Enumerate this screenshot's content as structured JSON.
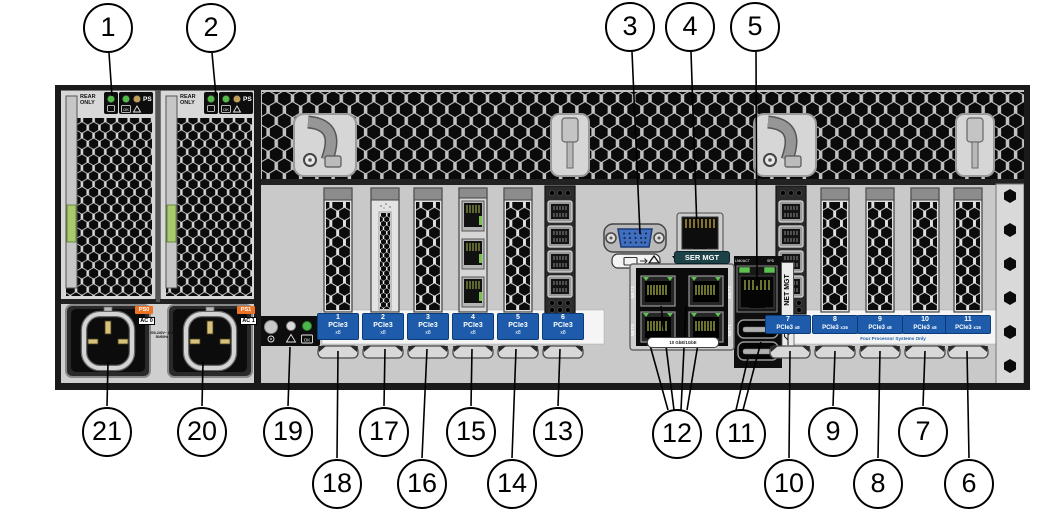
{
  "callouts": [
    "1",
    "2",
    "3",
    "4",
    "5",
    "6",
    "7",
    "8",
    "9",
    "10",
    "11",
    "12",
    "13",
    "14",
    "15",
    "16",
    "17",
    "18",
    "19",
    "20",
    "21"
  ],
  "psu": {
    "rear_only": "REAR ONLY",
    "ps": "PS",
    "ok": "OK",
    "supplies": [
      {
        "name": "PS0",
        "inlet": "AC 0"
      },
      {
        "name": "PS1",
        "inlet": "AC 1"
      }
    ],
    "rating": "200-240V~ 12A 50/60Hz"
  },
  "ports": {
    "ser_mgt": "SER MGT",
    "net_mgt": "NET MGT",
    "lnk_act": "LNK/ACT",
    "spd": "SPD",
    "net_ports": [
      "NET0",
      "NET1",
      "NET2",
      "NET3"
    ],
    "net_speed": "10 GbE/1GbE"
  },
  "status_panel": {
    "ok": "OK"
  },
  "slots": {
    "items": [
      {
        "num": "1",
        "gen": "PCIe3",
        "lanes": "x8"
      },
      {
        "num": "2",
        "gen": "PCIe3",
        "lanes": "x8"
      },
      {
        "num": "3",
        "gen": "PCIe3",
        "lanes": "x8"
      },
      {
        "num": "4",
        "gen": "PCIe3",
        "lanes": "x8"
      },
      {
        "num": "5",
        "gen": "PCIe3",
        "lanes": "x8"
      },
      {
        "num": "6",
        "gen": "PCIe3",
        "lanes": "x8"
      },
      {
        "num": "7",
        "gen": "PCIe3",
        "lanes": "x8"
      },
      {
        "num": "8",
        "gen": "PCIe3",
        "lanes": "x16"
      },
      {
        "num": "9",
        "gen": "PCIe3",
        "lanes": "x8"
      },
      {
        "num": "10",
        "gen": "PCIe3",
        "lanes": "x8"
      },
      {
        "num": "11",
        "gen": "PCIe3",
        "lanes": "x16"
      }
    ],
    "note": "Four Processor Systems Only"
  }
}
